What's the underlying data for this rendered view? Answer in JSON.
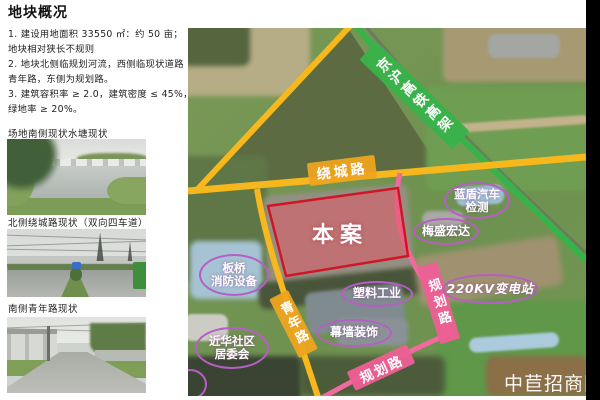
{
  "header": {
    "title": "地块概况"
  },
  "notes": {
    "lines": [
      "1. 建设用地面积 33550 ㎡：约 50 亩；",
      "地块相对狭长不规则",
      "2. 地块北侧临规划河流，西侧临现状道路",
      "青年路，东侧为规划路。",
      "3. 建筑容积率 ≥ 2.0，建筑密度 ≤ 45%，",
      "绿地率 ≥ 20%。"
    ]
  },
  "photos": [
    {
      "caption": "场地南侧现状水塘现状"
    },
    {
      "caption": "北侧绕城路现状（双向四车道）"
    },
    {
      "caption": "南侧青年路现状"
    }
  ],
  "map": {
    "site_label": "本案",
    "watermark": "中苣招商网",
    "roads": [
      {
        "name": "raocheng-road",
        "label": "绕城路",
        "color": "#f6b81c"
      },
      {
        "name": "qingnian-road",
        "label": "青年路",
        "color": "#f6b81c"
      },
      {
        "name": "planned-road-east",
        "label": "规划路",
        "color": "#ef6b9e"
      },
      {
        "name": "planned-road-south",
        "label": "规划路",
        "color": "#ef6b9e"
      },
      {
        "name": "jinghu-hsr-viaduct",
        "label": "京沪高铁高架",
        "color": "#39b24a"
      }
    ],
    "poi": [
      {
        "label": "蓝盾汽车\n检测"
      },
      {
        "label": "梅盛宏达"
      },
      {
        "label": "板桥\n消防设备"
      },
      {
        "label": "塑料工业"
      },
      {
        "label": "幕墙装饰"
      },
      {
        "label": "近华社区\n居委会"
      },
      {
        "label": "220KV变电站"
      }
    ],
    "colors": {
      "plot_outline": "#d01527",
      "plot_fill": "rgba(232,85,100,0.5)",
      "poi_outline": "#b75ec6"
    }
  }
}
